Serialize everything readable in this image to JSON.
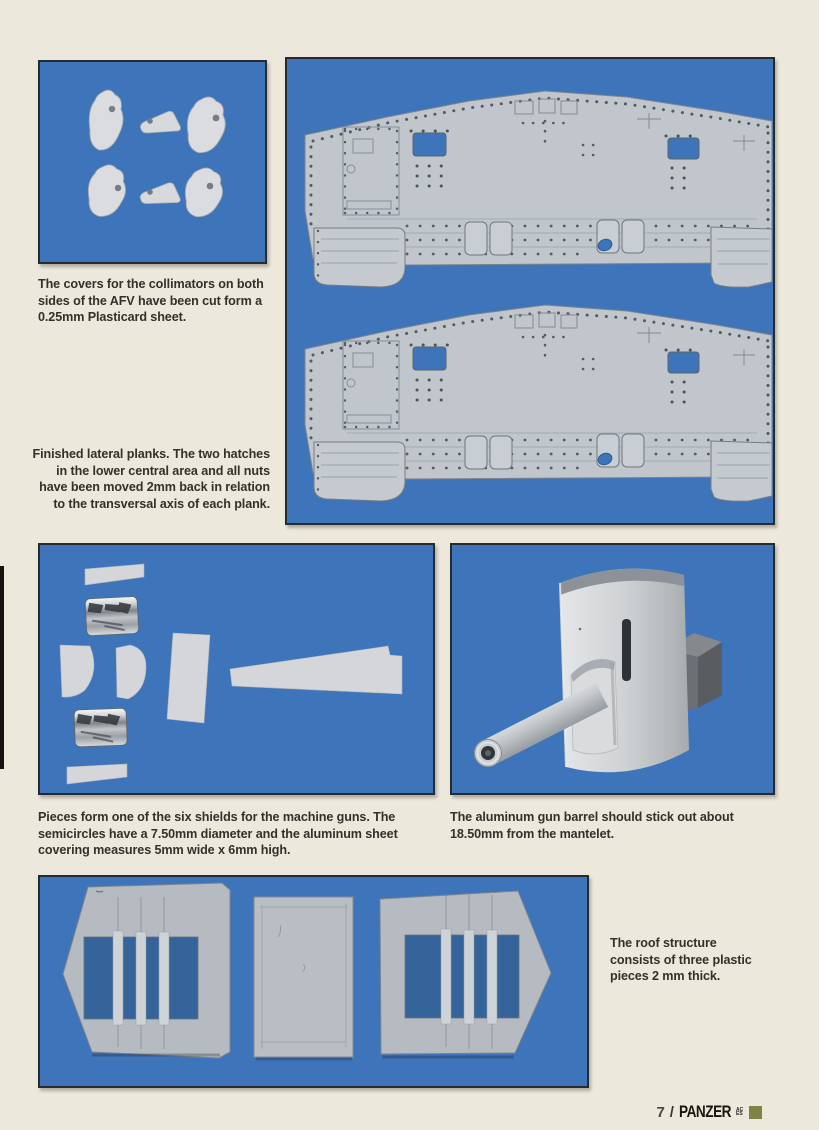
{
  "page": {
    "background_color": "#ECE8DC",
    "photo_background_color": "#3D74BA",
    "captions": {
      "collimators": "The covers for the collimators on both sides of the AFV have been cut form a 0.25mm Plasticard sheet.",
      "lateral_planks": "Finished lateral planks. The two hatches in the lower central area and all nuts have been moved 2mm back in relation to the transversal axis of each plank.",
      "shield_pieces": "Pieces form one of the six shields for the machine guns. The semicircles have a 7.50mm diameter and the aluminum sheet covering measures 5mm wide x 6mm high.",
      "gun_barrel": "The aluminum gun barrel should stick out about 18.50mm from the mantelet.",
      "roof": "The roof structure consists of three plastic pieces 2 mm thick."
    },
    "footer": {
      "page_number": "7",
      "separator": "/",
      "magazine": "PANZER",
      "magazine_suffix": "ACES",
      "accent_color": "#7D8446"
    }
  }
}
